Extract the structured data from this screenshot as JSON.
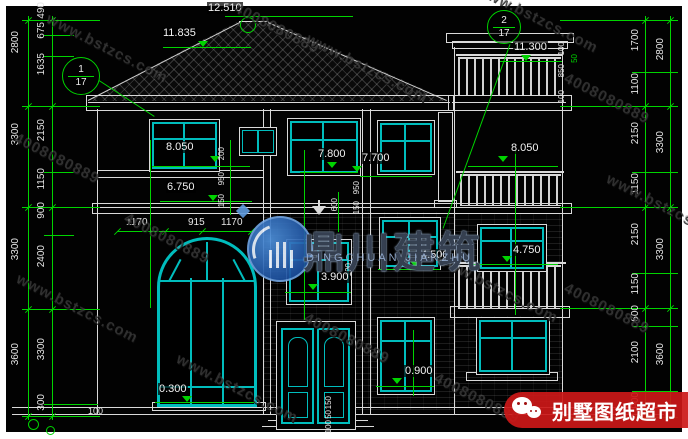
{
  "detail_refs": {
    "ref1": {
      "num": "1",
      "den": "17"
    },
    "ref2": {
      "num": "2",
      "den": "17"
    }
  },
  "elevations": {
    "peak": "12.510",
    "eave": "11.835",
    "tower_parapet": "11.300",
    "w1_sill": "8.050",
    "w3_sill": "7.800",
    "w4_sill": "7.700",
    "tower3f_sill": "8.050",
    "porch": "6.750",
    "cr_sill": "4.500",
    "balcony_sill": "4.750",
    "stair_sill": "3.900",
    "f1_sill": "0.900",
    "arch_sill": "0.300"
  },
  "dims": {
    "left_outer": [
      "2800",
      "3300",
      "3300",
      "3600"
    ],
    "left_inner": [
      "490",
      "675",
      "1635",
      "2150",
      "1150",
      "900",
      "2400",
      "3300",
      "300"
    ],
    "right_outer": [
      "2800",
      "3300",
      "3300",
      "3600"
    ],
    "right_inner": [
      "1700",
      "1100",
      "2150",
      "1150",
      "2150",
      "1150",
      "600",
      "2100",
      "900"
    ],
    "window_row": [
      "1170",
      "915",
      "1170"
    ],
    "small": [
      "200",
      "950",
      "150",
      "600",
      "100",
      "950",
      "150",
      "100",
      "850",
      "100",
      "50",
      "150",
      "50",
      "100",
      "100"
    ]
  },
  "watermark": {
    "site": "www.bstzcs.com",
    "phone": "4008080889",
    "logo_cn": "鼎川建筑",
    "logo_en": "DINGCHUAN JIANZHU"
  },
  "banner": {
    "label": "别墅图纸超市"
  }
}
